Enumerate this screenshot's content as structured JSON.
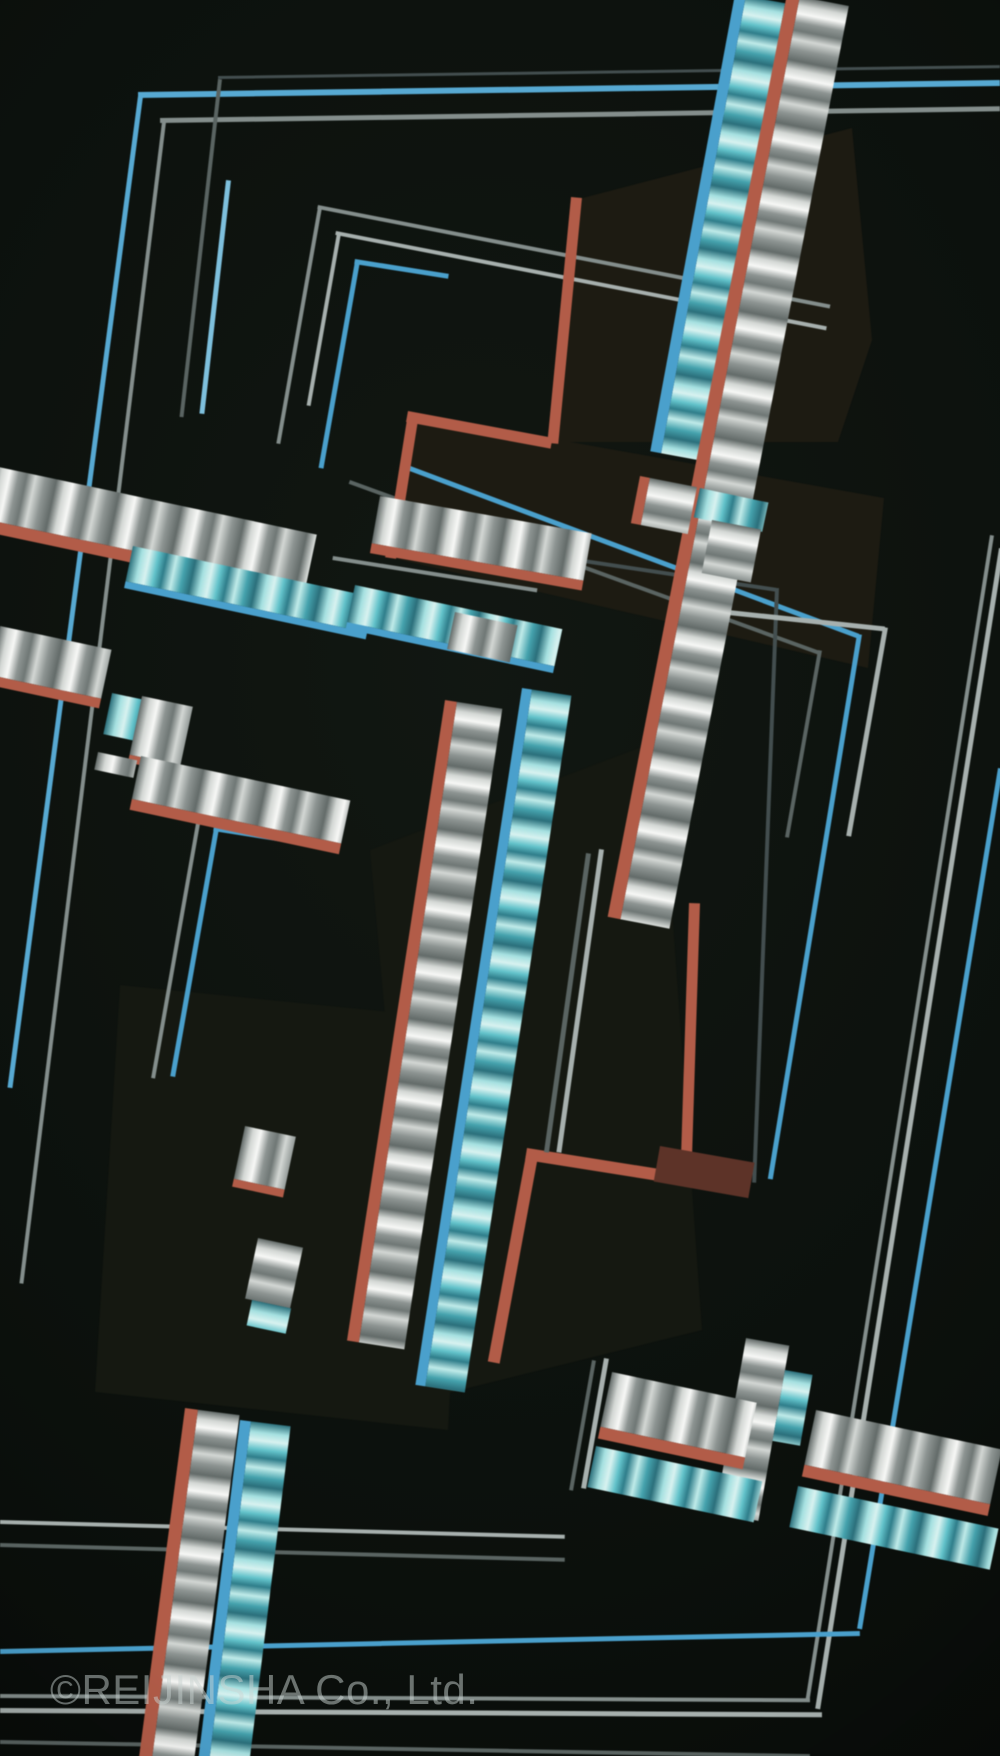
{
  "artwork": {
    "kind": "photograph of an abstract geometric constructivist collage (dark panels, tilted frame lines, gradient-striped ribbons)",
    "watermark": "©REIJINSHA Co., Ltd."
  },
  "palette": {
    "bg": "#0c110d",
    "bgDeep": "#070b09",
    "panelWarm": "#1d1b12",
    "panelCool": "#151811",
    "blue": "#4aa0cc",
    "blueSky": "#57a9d2",
    "blueLight": "#7ec0dd",
    "grayLight": "#a7b0ae",
    "grayMid": "#848e8c",
    "grayDark": "#5a6462",
    "grayDeep": "#434e4f",
    "red": "#b25c48",
    "redDark": "#5d3328",
    "stripeWhite": "#f7f8f6",
    "stripeLight": "#d3d7d4",
    "stripeMid": "#8d9492",
    "stripeDark": "#636b69",
    "cyanLight": "#d8f2f0",
    "cyanMid": "#62c2ca",
    "cyanDark": "#2f7d8a",
    "cyanDeep": "#2b6f7b",
    "watermark": "rgba(203,213,212,0.5)"
  }
}
